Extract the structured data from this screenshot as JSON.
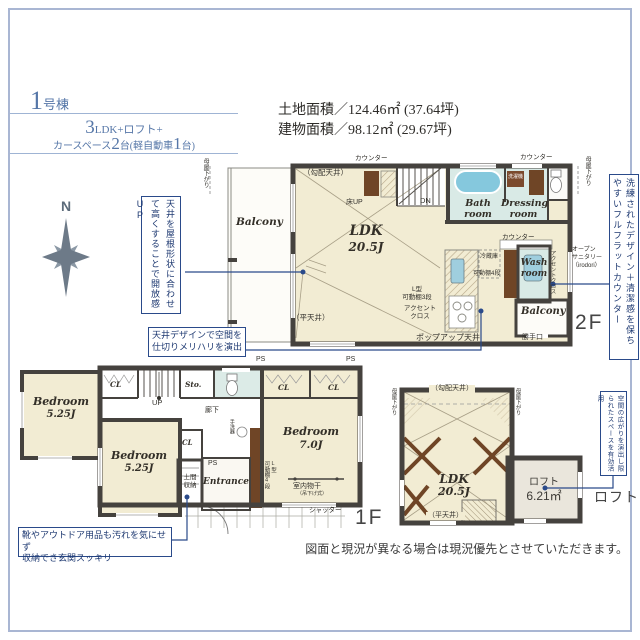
{
  "colors": {
    "accent_blue": "#2a4a8a",
    "title_blue": "#5677a8",
    "frame_blue": "#a9b6d3",
    "floor_cream": "#f2ecd3",
    "wet_area_floor": "#d9eae6",
    "loft_floor": "#eae6dc",
    "wall_dark": "#45423e",
    "bathtub_blue": "#85c8dd",
    "wood_brown": "#6f4526"
  },
  "header": {
    "building_num": "1",
    "building_suffix": "号棟",
    "spec_num": "3",
    "spec_rest": "LDK+ロフト+",
    "car_pre": "カースペース",
    "car_num": "2",
    "car_mid": "台(軽自動車",
    "car_num2": "1",
    "car_post": "台)",
    "land_area": "土地面積／124.46㎡ (37.64坪)",
    "building_area": "建物面積／98.12㎡ (29.67坪)"
  },
  "compass": {
    "n": "N"
  },
  "terms": {
    "counter": "カウンター",
    "moya": "母屋下がり",
    "cl": "CL",
    "ps": "PS",
    "slope_ceiling": "（勾配天井）",
    "flat_ceiling": "（平天井）",
    "balcony": "Balcony",
    "ldk": "LDK",
    "ldk_size": "20.5J",
    "bedroom": "Bedroom"
  },
  "callouts": {
    "ceiling_height": "天井を屋根形状に合わせて高くすることで開放感UP",
    "ceiling_design_l1": "天井デザインで空間を",
    "ceiling_design_l2": "仕切りメリハリを演出",
    "flat_counter": "洗練されたデザイン＋清潔感を保ちやすいフルフラットカウンター",
    "loft_space": "空間の広がりを演出し限られたスペースを有効活用",
    "genkan_l1": "靴やアウトドア用品も汚れを気にせず",
    "genkan_l2": "収納でき玄関スッキリ"
  },
  "plan2f": {
    "floor_label": "2F",
    "floor_up": "床UP",
    "dn": "DN",
    "bath": "Bath room",
    "dressing": "Dressing room",
    "wash": "Wash room",
    "washer": "洗濯機",
    "accent_wall": "アクセントクロス",
    "open_sanitary_l1": "オープン",
    "open_sanitary_l2": "サニタリー",
    "open_sanitary_l3": "（irodori）",
    "fridge": "冷蔵庫",
    "shelf4": "可動棚4段",
    "lshelf_l1": "L型",
    "lshelf_l2": "可動棚3段",
    "accent_l1": "アクセント",
    "accent_l2": "クロス",
    "popup_ceiling": "ポップアップ天井",
    "back_door": "勝手口"
  },
  "plan1f": {
    "floor_label": "1F",
    "sto": "Sto.",
    "up": "UP",
    "hallway": "廊下",
    "bedroom1_size": "5.25J",
    "bedroom2_size": "5.25J",
    "bedroom3_size": "7.0J",
    "hand_wash": "手洗器",
    "doma_l1": "土間",
    "doma_l2": "収納",
    "entrance": "Entrance",
    "shelf_a": "L型",
    "shelf_b": "可動棚4段",
    "monohoshi": "室内物干",
    "monohoshi_sub": "（吊下げ式）",
    "shutter": "シャッター"
  },
  "loft": {
    "floor_label": "ロフト",
    "name": "ロフト",
    "size": "6.21㎡"
  },
  "footer": {
    "disclaimer": "図面と現況が異なる場合は現況優先とさせていただきます。"
  }
}
